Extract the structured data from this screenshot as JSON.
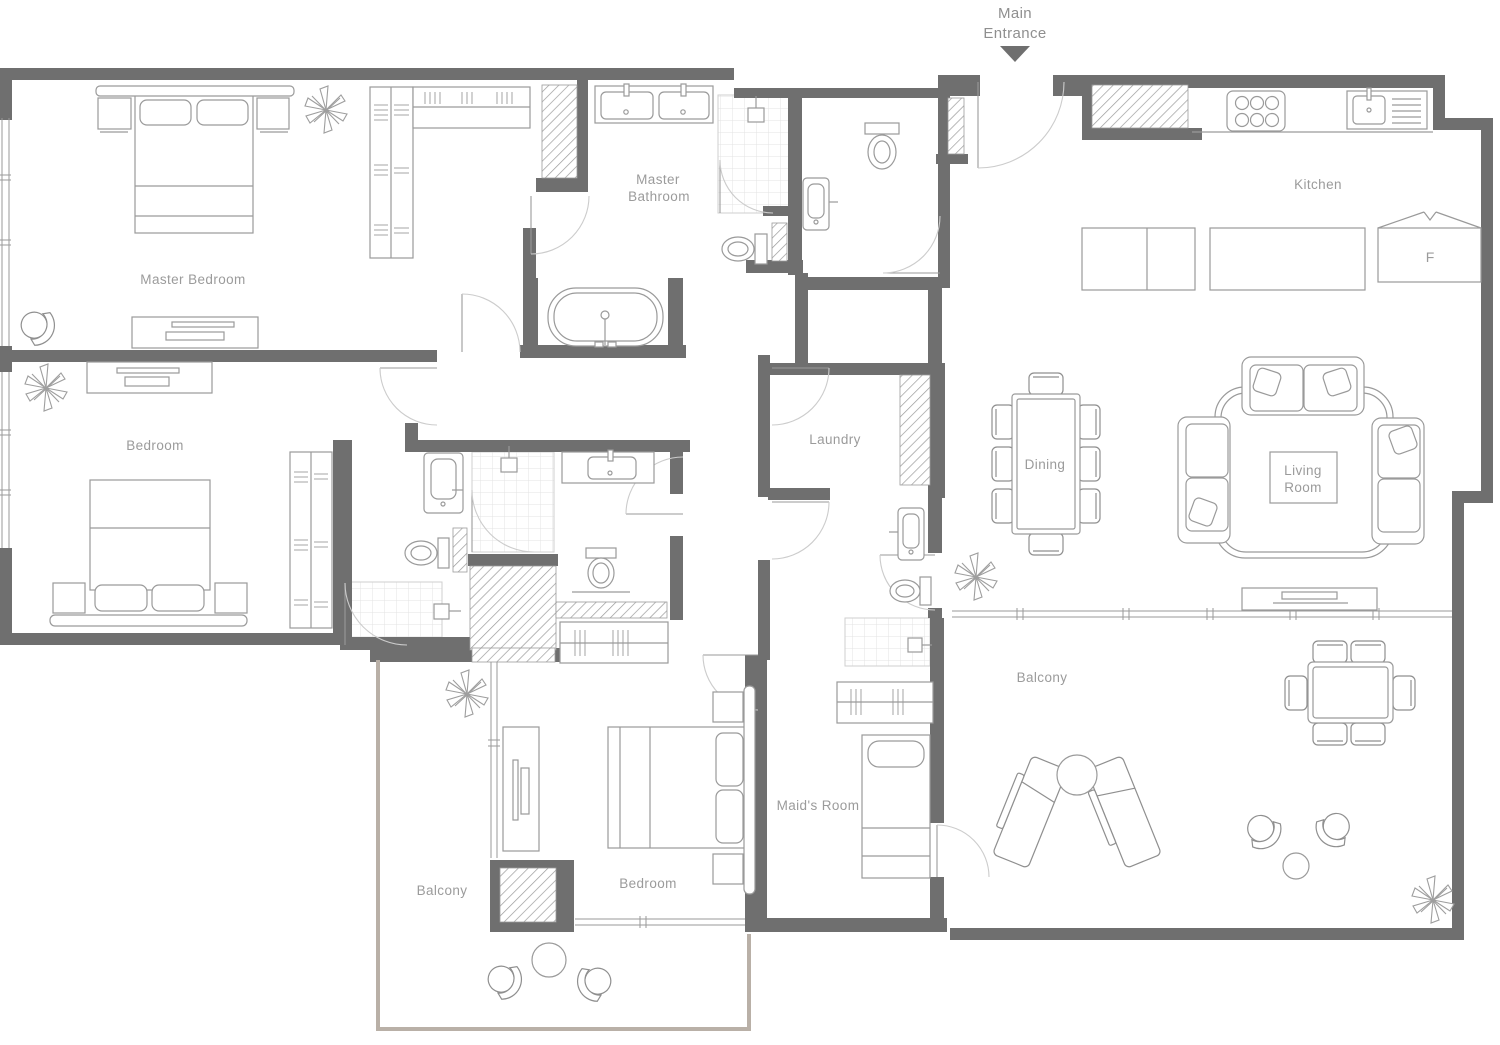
{
  "plan": {
    "colors": {
      "wall": "#6f6f6f",
      "furniture_line": "#9a9a9a",
      "door_arc": "#cccccc",
      "label": "#9b9b9b",
      "balcony_outline": "#b9b0a7",
      "tile_line": "#e3e3e3",
      "entrance_arrow": "#6f6f6f"
    },
    "entrance": {
      "line1": "Main",
      "line2": "Entrance"
    },
    "rooms": {
      "master_bedroom": "Master Bedroom",
      "master_bathroom_line1": "Master",
      "master_bathroom_line2": "Bathroom",
      "kitchen": "Kitchen",
      "bedroom_left": "Bedroom",
      "laundry": "Laundry",
      "dining": "Dining",
      "living_line1": "Living",
      "living_line2": "Room",
      "balcony_left": "Balcony",
      "bedroom_lower": "Bedroom",
      "maids_room": "Maid's Room",
      "balcony_right": "Balcony",
      "fridge": "F"
    }
  }
}
